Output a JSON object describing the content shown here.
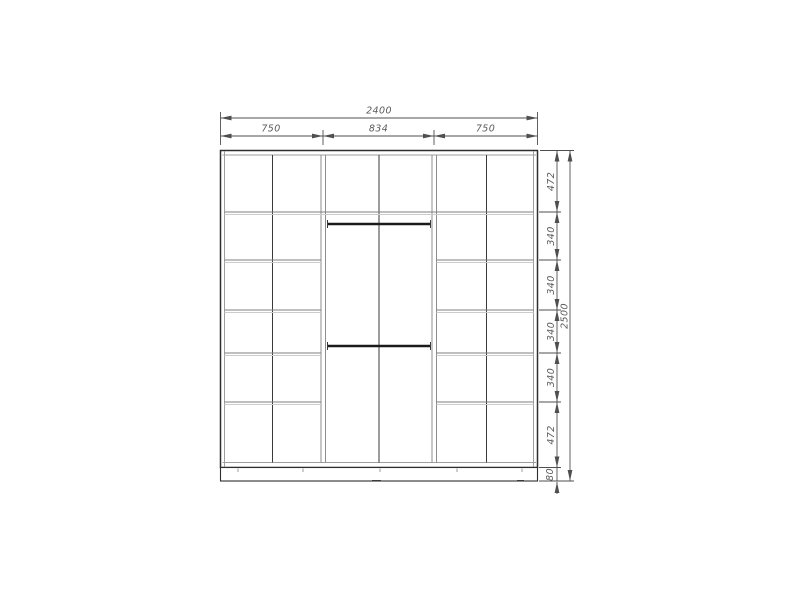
{
  "drawing": {
    "dims": {
      "total_width": "2400",
      "section_widths": [
        "750",
        "834",
        "750"
      ],
      "row_heights": [
        "472",
        "340",
        "340",
        "340",
        "340",
        "472"
      ],
      "plinth_height": "80",
      "total_height": "2500"
    },
    "colors": {
      "background": "#ffffff",
      "line_dark": "#2e2e2e",
      "line_light": "#9e9e9e",
      "dimension": "#4f4f4f",
      "text": "#5a5a5a"
    }
  }
}
